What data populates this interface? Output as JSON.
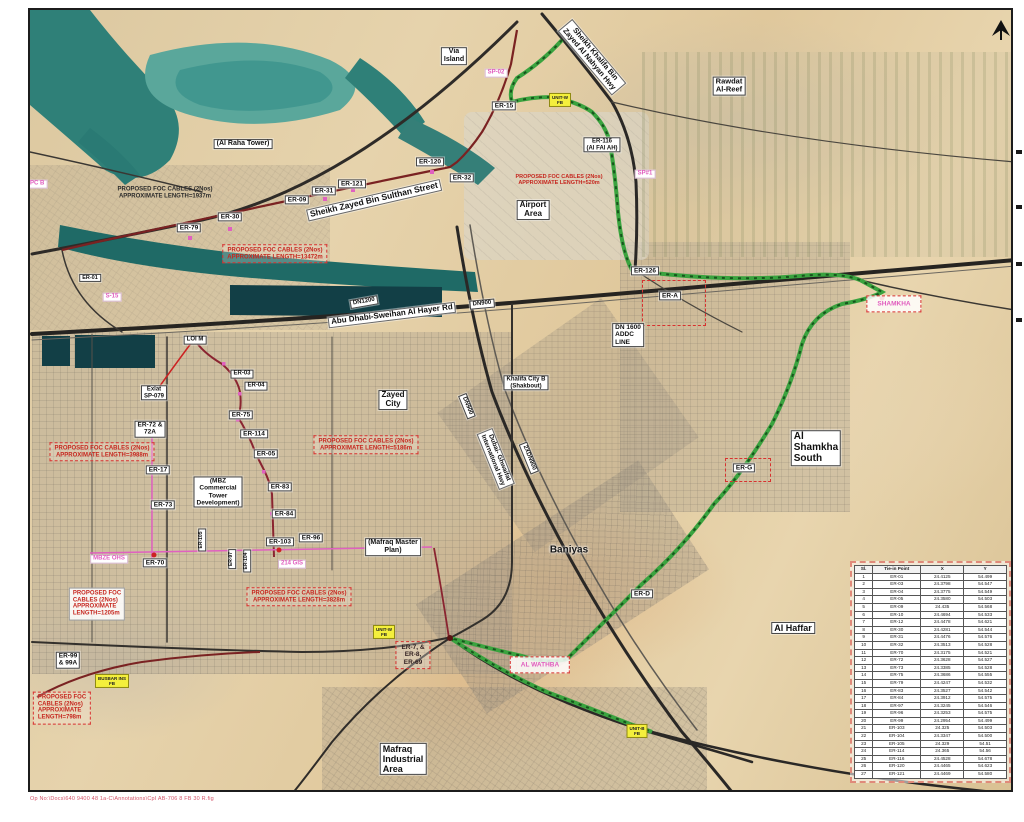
{
  "meta": {
    "caption": "Op No:\\Docs\\640 9400 48 1a-C\\Annotations\\CpI AB-706 8 FB 30 R.fig",
    "north_arrow": "north-arrow"
  },
  "colors": {
    "route_green": "#3aa33f",
    "route_green_dash": "#17541d",
    "cable_maroon": "#7a2222",
    "cable_pink": "#e060c0",
    "marker_red": "#cc2222",
    "label_yellow": "#f4ef3c",
    "water": "#2f8078",
    "sand": "#e0cda4"
  },
  "labels": [
    {
      "n": "label-er-15",
      "t": "er",
      "text": "ER-15",
      "x": 502,
      "y": 104
    },
    {
      "n": "label-er-116",
      "t": "er",
      "text": "ER-116\n(Al FAl AH)",
      "x": 600,
      "y": 143,
      "fs": 6
    },
    {
      "n": "label-er-120",
      "t": "er",
      "text": "ER-120",
      "x": 428,
      "y": 160
    },
    {
      "n": "label-er-121",
      "t": "er",
      "text": "ER-121",
      "x": 350,
      "y": 182
    },
    {
      "n": "label-er-32",
      "t": "er",
      "text": "ER-32",
      "x": 460,
      "y": 176
    },
    {
      "n": "label-er-31",
      "t": "er",
      "text": "ER-31",
      "x": 322,
      "y": 189
    },
    {
      "n": "label-er-09",
      "t": "er",
      "text": "ER-09",
      "x": 295,
      "y": 198
    },
    {
      "n": "label-er-30",
      "t": "er",
      "text": "ER-30",
      "x": 228,
      "y": 215
    },
    {
      "n": "label-er-79",
      "t": "er",
      "text": "ER-79",
      "x": 187,
      "y": 226
    },
    {
      "n": "label-er-126",
      "t": "er",
      "text": "ER-126",
      "x": 643,
      "y": 269
    },
    {
      "n": "label-er-a",
      "t": "er",
      "text": "ER-A",
      "x": 668,
      "y": 294
    },
    {
      "n": "label-er-g",
      "t": "er",
      "text": "ER-G",
      "x": 742,
      "y": 466
    },
    {
      "n": "label-er-d",
      "t": "er",
      "text": "ER-D",
      "x": 640,
      "y": 592
    },
    {
      "n": "label-er-01",
      "t": "er",
      "text": "ER-01",
      "x": 88,
      "y": 276,
      "fs": 5.5
    },
    {
      "n": "label-er-03",
      "t": "er",
      "text": "ER-03",
      "x": 240,
      "y": 372,
      "fs": 6
    },
    {
      "n": "label-er-04",
      "t": "er",
      "text": "ER-04",
      "x": 254,
      "y": 384,
      "fs": 6
    },
    {
      "n": "label-er-75",
      "t": "er",
      "text": "ER-75",
      "x": 239,
      "y": 413
    },
    {
      "n": "label-er-114",
      "t": "er",
      "text": "ER-114",
      "x": 252,
      "y": 432
    },
    {
      "n": "label-er-05",
      "t": "er",
      "text": "ER-05",
      "x": 264,
      "y": 452
    },
    {
      "n": "label-er-72",
      "t": "er",
      "text": "ER-72 &\n72A",
      "x": 148,
      "y": 427
    },
    {
      "n": "label-er-17",
      "t": "er",
      "text": "ER-17",
      "x": 156,
      "y": 468
    },
    {
      "n": "label-er-73",
      "t": "er",
      "text": "ER-73",
      "x": 161,
      "y": 503
    },
    {
      "n": "label-er-83",
      "t": "er",
      "text": "ER-83",
      "x": 278,
      "y": 485
    },
    {
      "n": "label-er-84",
      "t": "er",
      "text": "ER-84",
      "x": 282,
      "y": 512
    },
    {
      "n": "label-er-103",
      "t": "er",
      "text": "ER-103",
      "x": 278,
      "y": 540
    },
    {
      "n": "label-er-96",
      "t": "er",
      "text": "ER-96",
      "x": 309,
      "y": 536
    },
    {
      "n": "label-er-70",
      "t": "er",
      "text": "ER-70",
      "x": 153,
      "y": 561
    },
    {
      "n": "label-er-99",
      "t": "er",
      "text": "ER-99\n& 99A",
      "x": 66,
      "y": 658
    },
    {
      "n": "label-er-105",
      "t": "er",
      "text": "ER-105",
      "x": 200,
      "y": 538,
      "r": -90,
      "fs": 5
    },
    {
      "n": "label-er-97",
      "t": "er",
      "text": "ER-97",
      "x": 230,
      "y": 557,
      "r": -90,
      "fs": 5
    },
    {
      "n": "label-er-104",
      "t": "er",
      "text": "ER-104",
      "x": 245,
      "y": 559,
      "r": -90,
      "fs": 5
    },
    {
      "n": "label-via-island",
      "t": "area",
      "text": "Via\nIsland",
      "x": 452,
      "y": 54,
      "fs": 7
    },
    {
      "n": "label-al-raha-tower",
      "t": "area",
      "text": "(Al Raha Tower)",
      "x": 241,
      "y": 142,
      "fs": 7
    },
    {
      "n": "label-airport-area",
      "t": "area",
      "text": "Airport\nArea",
      "x": 531,
      "y": 208
    },
    {
      "n": "label-rawdat-al-reef",
      "t": "area",
      "text": "Rawdat\nAl-Reef",
      "x": 727,
      "y": 84,
      "fs": 7.5
    },
    {
      "n": "label-zayed-city",
      "t": "area",
      "text": "Zayed\nCity",
      "x": 391,
      "y": 398
    },
    {
      "n": "label-khalifa-city-b",
      "t": "area",
      "text": "Khalifa City B\n(Shakbout)",
      "x": 524,
      "y": 381,
      "fs": 6
    },
    {
      "n": "label-al-shamkha-south",
      "t": "area",
      "text": "Al\nShamkha\nSouth",
      "x": 814,
      "y": 446,
      "fs": 10,
      "align": "left"
    },
    {
      "n": "label-al-haffar",
      "t": "area",
      "text": "Al Haffar",
      "x": 791,
      "y": 626,
      "fs": 9
    },
    {
      "n": "label-baniyas",
      "t": "plain",
      "text": "Baniyas",
      "x": 567,
      "y": 548
    },
    {
      "n": "label-mafraq-industrial",
      "t": "area",
      "text": "Mafraq\nIndustrial\nArea",
      "x": 401,
      "y": 757,
      "fs": 9,
      "align": "left"
    },
    {
      "n": "label-mbz-commercial",
      "t": "area",
      "text": "(MBZ\nCommercial\nTower\nDevelopment)",
      "x": 216,
      "y": 490,
      "fs": 6.5
    },
    {
      "n": "label-mafraq-master-plan",
      "t": "area",
      "text": "(Mafraq Master\nPlan)",
      "x": 391,
      "y": 545,
      "fs": 7
    },
    {
      "n": "label-dn1600-addc",
      "t": "area",
      "text": "DN 1600\nADDC\nLINE",
      "x": 626,
      "y": 333,
      "fs": 6.5,
      "align": "left"
    },
    {
      "n": "label-exlat-sp079",
      "t": "area",
      "text": "Exlat\nSP-079",
      "x": 152,
      "y": 391,
      "fs": 6
    },
    {
      "n": "label-loi-m",
      "t": "area",
      "text": "LOI M",
      "x": 193,
      "y": 338,
      "fs": 6
    },
    {
      "n": "label-dn1200",
      "t": "area",
      "text": "DN1200",
      "x": 362,
      "y": 300,
      "r": -10,
      "fs": 6
    },
    {
      "n": "label-dn900-road",
      "t": "area",
      "text": "DN900",
      "x": 480,
      "y": 302,
      "r": -5,
      "fs": 6
    },
    {
      "n": "label-dn900-hwy",
      "t": "area",
      "text": "DN900",
      "x": 465,
      "y": 404,
      "r": 68,
      "fs": 6
    },
    {
      "n": "label-2xdn900",
      "t": "area",
      "text": "2XDN900",
      "x": 527,
      "y": 456,
      "r": 68,
      "fs": 6
    },
    {
      "n": "label-sheikh-zayed-street",
      "t": "road",
      "text": "Sheikh Zayed Bin Sulthan Street",
      "x": 372,
      "y": 198,
      "r": -13,
      "fs": 8.5
    },
    {
      "n": "label-al-hayer-road",
      "t": "road",
      "text": "Abu Dhabi-Sweihan Al Hayer Rd",
      "x": 390,
      "y": 313,
      "r": -7,
      "fs": 8
    },
    {
      "n": "label-sheikh-khalifa-hwy",
      "t": "road",
      "text": "Sheikh Khalifa Bin\nZayed Al Nahyan Hwy",
      "x": 590,
      "y": 55,
      "r": 50,
      "fs": 7.5
    },
    {
      "n": "label-ghwaifat-hwy",
      "t": "road",
      "text": "Dubai- Ghwaifat\nInternational Hwy",
      "x": 494,
      "y": 457,
      "r": 68,
      "fs": 6.5
    },
    {
      "n": "label-upc-b",
      "t": "pink",
      "text": "UPC B",
      "x": 33,
      "y": 182
    },
    {
      "n": "label-s-15",
      "t": "pink",
      "text": "S-15",
      "x": 110,
      "y": 295
    },
    {
      "n": "label-sp-02",
      "t": "pink",
      "text": "SP-02",
      "x": 494,
      "y": 71
    },
    {
      "n": "label-sp-1",
      "t": "pink",
      "text": "SP#1",
      "x": 643,
      "y": 172
    },
    {
      "n": "label-mbze-ohs",
      "t": "pink",
      "text": "MBZE OHS",
      "x": 107,
      "y": 557
    },
    {
      "n": "label-214-gis",
      "t": "pink",
      "text": "214 GIS",
      "x": 290,
      "y": 562
    },
    {
      "n": "label-al-wathba",
      "t": "pinkbox",
      "text": "AL WATHBA",
      "x": 538,
      "y": 663
    },
    {
      "n": "label-shamkha",
      "t": "pinkbox",
      "text": "SHAMKHA",
      "x": 892,
      "y": 302
    },
    {
      "n": "label-unit-w-north",
      "t": "yellow",
      "text": "UNIT-W\nFB",
      "x": 558,
      "y": 98
    },
    {
      "n": "label-unit-w-mafraq",
      "t": "yellow",
      "text": "UNIT-W\nFB",
      "x": 382,
      "y": 630
    },
    {
      "n": "label-unit-b",
      "t": "yellow",
      "text": "UNIT-B\nFB",
      "x": 635,
      "y": 729
    },
    {
      "n": "label-busbar-fb",
      "t": "yellow",
      "text": "BUSBAR INS\nFB",
      "x": 110,
      "y": 679
    },
    {
      "n": "callout-foc-1937",
      "t": "dark",
      "text": "PROPOSED FOC CABLES (2Nos)\nAPPROXIMATE LENGTH=1937m",
      "x": 163,
      "y": 191
    },
    {
      "n": "callout-foc-13472",
      "t": "redbox",
      "text": "PROPOSED FOC CABLES (2Nos)\nAPPROXIMATE LENGTH=13472m",
      "x": 273,
      "y": 252
    },
    {
      "n": "callout-foc-520",
      "t": "redtext",
      "text": "PROPOSED FOC CABLES (2Nos)\nAPPROXIMATE LENGTH=520m",
      "x": 557,
      "y": 178
    },
    {
      "n": "callout-foc-5186",
      "t": "redbox",
      "text": "PROPOSED FOC CABLES (2Nos)\nAPPROXIMATE LENGTH=5186m",
      "x": 364,
      "y": 443
    },
    {
      "n": "callout-foc-3988",
      "t": "redbox",
      "text": "PROPOSED FOC CABLES (2Nos)\nAPPROXIMATE LENGTH=3988m",
      "x": 100,
      "y": 450
    },
    {
      "n": "callout-foc-1205",
      "t": "redwhite",
      "text": "PROPOSED FOC\nCABLES (2Nos)\nAPPROXIMATE\nLENGTH=1205m",
      "x": 95,
      "y": 602
    },
    {
      "n": "callout-foc-798",
      "t": "redbox",
      "text": "PROPOSED FOC\nCABLES (2Nos)\nAPPROXIMATE\nLENGTH=798m",
      "x": 60,
      "y": 706,
      "align": "left"
    },
    {
      "n": "callout-foc-3828",
      "t": "redbox",
      "text": "PROPOSED FOC CABLES (2Nos)\nAPPROXIMATE LENGTH=3828m",
      "x": 297,
      "y": 595
    },
    {
      "n": "callout-er7-group",
      "t": "redbox-dark",
      "text": "ER-7, &\nER-8,\nER-69",
      "x": 411,
      "y": 653
    }
  ],
  "table": {
    "headers": [
      "Sl.",
      "Tie-in Point",
      "X",
      "Y"
    ],
    "rows": [
      [
        "1",
        "ER-01",
        "24.4125",
        "54.499"
      ],
      [
        "2",
        "ER-03",
        "24.3798",
        "54.547"
      ],
      [
        "3",
        "ER-04",
        "24.3775",
        "54.549"
      ],
      [
        "4",
        "ER-05",
        "24.3580",
        "54.503"
      ],
      [
        "5",
        "ER-09",
        "24.435",
        "54.568"
      ],
      [
        "6",
        "ER-10",
        "24.4694",
        "54.533"
      ],
      [
        "7",
        "ER-12",
        "24.4478",
        "54.621"
      ],
      [
        "8",
        "ER-30",
        "24.4281",
        "54.544"
      ],
      [
        "9",
        "ER-31",
        "24.4476",
        "54.576"
      ],
      [
        "10",
        "ER-32",
        "24.3513",
        "54.528"
      ],
      [
        "11",
        "ER-70",
        "24.3175",
        "54.521"
      ],
      [
        "12",
        "ER-72",
        "24.3628",
        "54.527"
      ],
      [
        "13",
        "ER-73",
        "24.3385",
        "54.528"
      ],
      [
        "14",
        "ER-75",
        "24.3686",
        "54.555"
      ],
      [
        "15",
        "ER-79",
        "24.4247",
        "54.532"
      ],
      [
        "16",
        "ER-83",
        "24.3527",
        "54.542"
      ],
      [
        "17",
        "ER-84",
        "24.3912",
        "54.575"
      ],
      [
        "18",
        "ER-97",
        "24.3245",
        "54.546"
      ],
      [
        "19",
        "ER-96",
        "24.3253",
        "54.575"
      ],
      [
        "20",
        "ER-99",
        "24.2954",
        "54.499"
      ],
      [
        "21",
        "ER-103",
        "24.325",
        "54.503"
      ],
      [
        "22",
        "ER-104",
        "24.3347",
        "54.500"
      ],
      [
        "23",
        "ER-105",
        "24.329",
        "54.51"
      ],
      [
        "24",
        "ER-114",
        "24.365",
        "54.56"
      ],
      [
        "25",
        "ER-116",
        "24.4528",
        "54.678"
      ],
      [
        "26",
        "ER-120",
        "24.4465",
        "54.623"
      ],
      [
        "27",
        "ER-121",
        "24.4469",
        "54.580"
      ]
    ]
  }
}
